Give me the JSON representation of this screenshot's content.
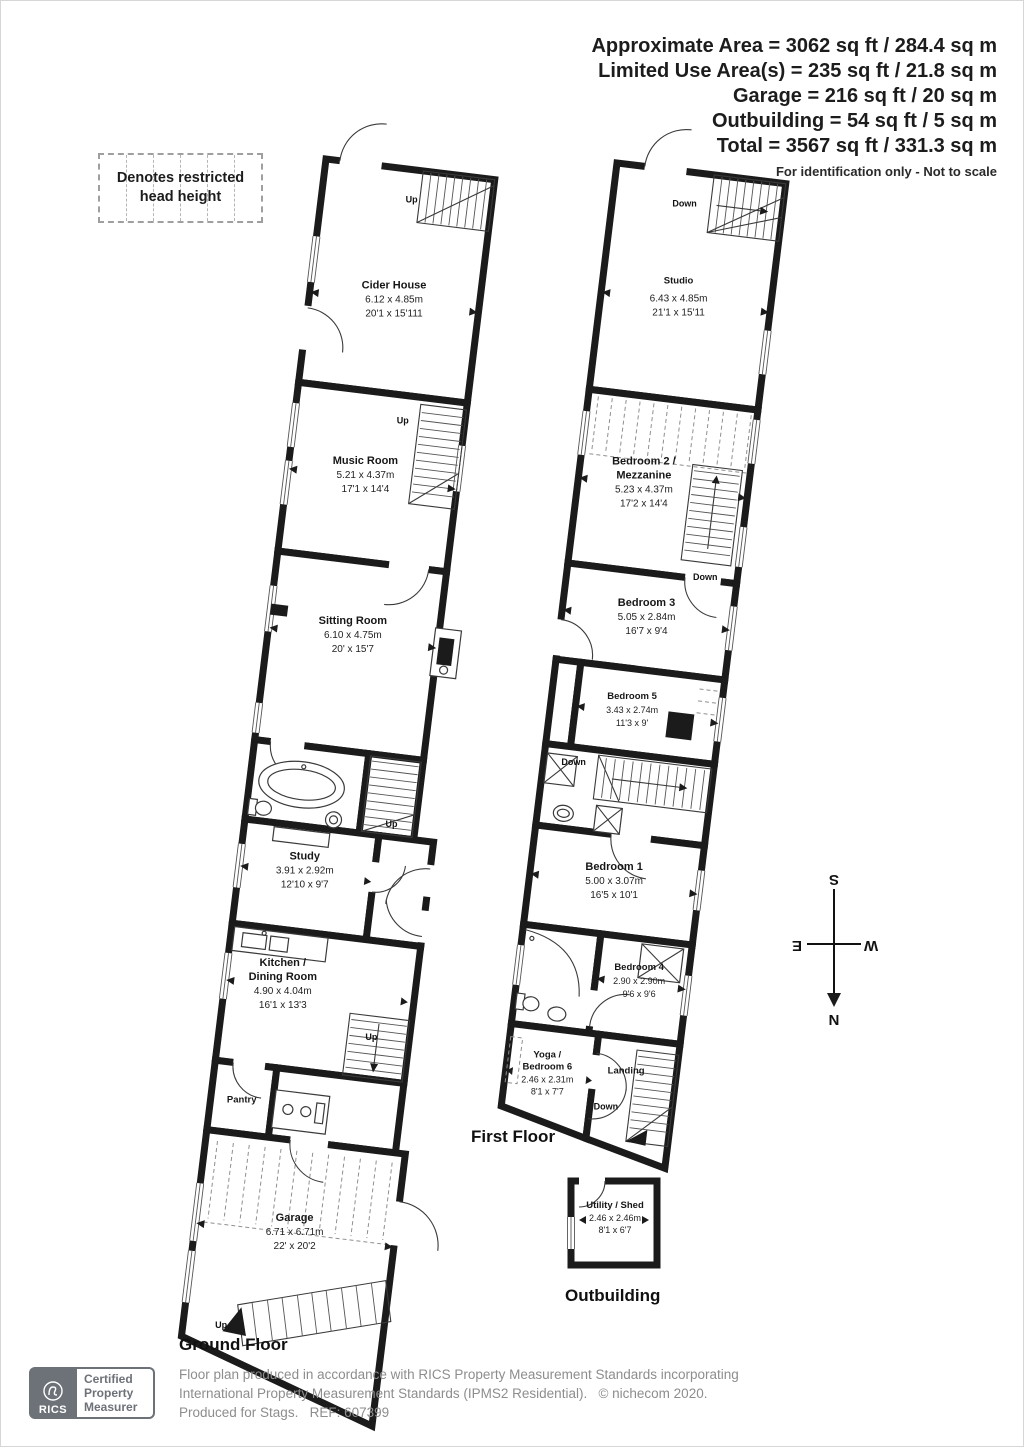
{
  "header": {
    "area_lines": [
      "Approximate Area = 3062 sq ft / 284.4 sq m",
      "Limited Use Area(s) = 235 sq ft / 21.8 sq m",
      "Garage = 216 sq ft / 20 sq m",
      "Outbuilding = 54 sq ft / 5 sq m",
      "Total = 3567 sq ft / 331.3 sq m"
    ],
    "disclaimer": "For identification only - Not to scale"
  },
  "legend": {
    "text_line1": "Denotes restricted",
    "text_line2": "head height"
  },
  "stairs": {
    "up": "Up",
    "down": "Down"
  },
  "compass": {
    "north": "N",
    "south": "S",
    "east": "E",
    "west": "W"
  },
  "floors": {
    "ground": {
      "label": "Ground Floor",
      "rooms": {
        "cider_house": {
          "name": "Cider House",
          "metric": "6.12 x 4.85m",
          "imperial": "20'1 x 15'111"
        },
        "music_room": {
          "name": "Music Room",
          "metric": "5.21 x 4.37m",
          "imperial": "17'1 x 14'4"
        },
        "sitting_room": {
          "name": "Sitting Room",
          "metric": "6.10 x 4.75m",
          "imperial": "20' x 15'7"
        },
        "study": {
          "name": "Study",
          "metric": "3.91 x 2.92m",
          "imperial": "12'10 x 9'7"
        },
        "kitchen_dining": {
          "name_line1": "Kitchen /",
          "name_line2": "Dining Room",
          "metric": "4.90 x 4.04m",
          "imperial": "16'1 x 13'3"
        },
        "pantry": {
          "name": "Pantry"
        },
        "garage": {
          "name": "Garage",
          "metric": "6.71 x 6.71m",
          "imperial": "22' x 20'2"
        }
      }
    },
    "first": {
      "label": "First Floor",
      "rooms": {
        "studio": {
          "name": "Studio",
          "metric": "6.43 x 4.85m",
          "imperial": "21'1 x 15'11"
        },
        "bedroom2": {
          "name_line1": "Bedroom 2 /",
          "name_line2": "Mezzanine",
          "metric": "5.23 x 4.37m",
          "imperial": "17'2 x 14'4"
        },
        "bedroom3": {
          "name": "Bedroom 3",
          "metric": "5.05 x 2.84m",
          "imperial": "16'7 x 9'4"
        },
        "bedroom5": {
          "name": "Bedroom 5",
          "metric": "3.43 x 2.74m",
          "imperial": "11'3 x 9'"
        },
        "bedroom1": {
          "name": "Bedroom 1",
          "metric": "5.00 x 3.07m",
          "imperial": "16'5 x 10'1"
        },
        "bedroom4": {
          "name": "Bedroom 4",
          "metric": "2.90 x 2.90m",
          "imperial": "9'6 x 9'6"
        },
        "yoga_bedroom6": {
          "name_line1": "Yoga /",
          "name_line2": "Bedroom 6",
          "metric": "2.46 x 2.31m",
          "imperial": "8'1 x 7'7"
        },
        "landing": {
          "name": "Landing"
        }
      }
    },
    "outbuilding": {
      "label": "Outbuilding",
      "rooms": {
        "utility_shed": {
          "name": "Utility / Shed",
          "metric": "2.46 x 2.46m",
          "imperial": "8'1 x 6'7"
        }
      }
    }
  },
  "footer": {
    "rics_logo": "RICS",
    "badge": [
      "Certified",
      "Property",
      "Measurer"
    ],
    "line1": "Floor plan produced in accordance with RICS Property Measurement Standards incorporating",
    "line2": "International Property Measurement Standards (IPMS2 Residential).   © nichecom 2020.",
    "line3": "Produced for Stags.   REF: 607399"
  },
  "colors": {
    "wall": "#1b1b1b",
    "background": "#ffffff",
    "badge_gray": "#6d7178"
  }
}
